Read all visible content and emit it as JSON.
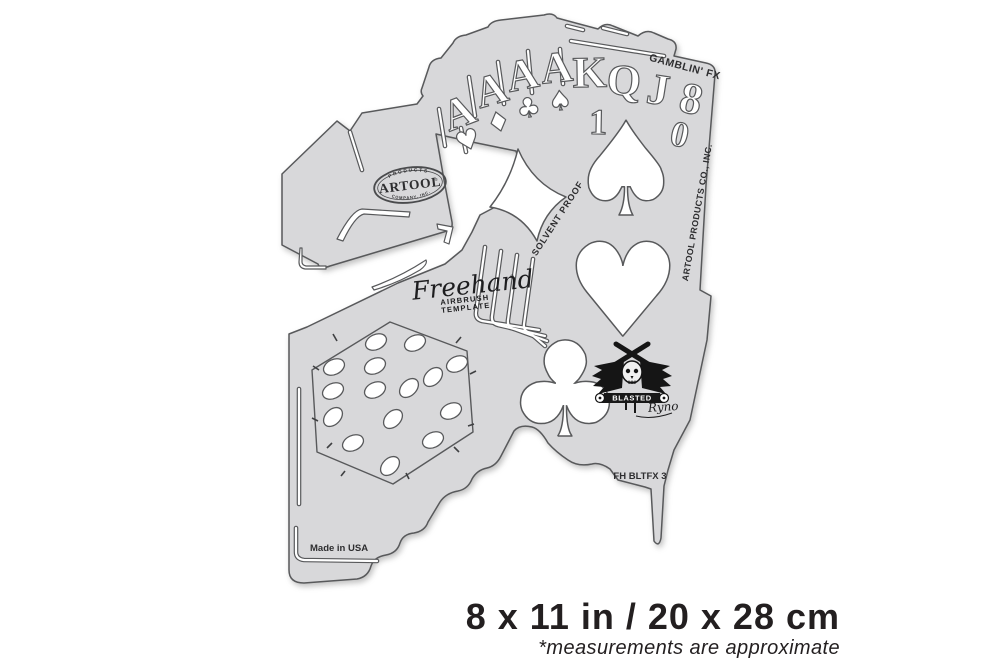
{
  "colors": {
    "background": "#ffffff",
    "template_fill": "#d8d8da",
    "outline": "#58595b",
    "print_dark": "#2d2d2f",
    "caption_text": "#231f20"
  },
  "template": {
    "series_label": "GAMBLIN' FX",
    "sku_label": "FH BLTFX 3",
    "made_in_label": "Made in USA",
    "solvent_proof_label": "SOLVENT PROOF",
    "side_label": "ARTOOL PRODUCTS CO., INC.",
    "brand_oval": {
      "top": "PRODUCTS",
      "name": "ARTOOL",
      "reg": "®",
      "bottom": "COMPANY, INC."
    },
    "freehand_logo": {
      "script": "Freehand",
      "reg": "®",
      "line1": "AIRBRUSH",
      "line2": "TEMPLATE"
    },
    "cards": {
      "ranks": [
        "A",
        "A",
        "A",
        "A",
        "K",
        "Q",
        "J",
        "8"
      ],
      "ten": [
        "1",
        "0"
      ],
      "suit_glyphs": {
        "heart": "♥",
        "diamond": "♦",
        "club": "♣",
        "spade": "♠"
      }
    },
    "artist_logo": {
      "word": "BLASTED",
      "signature": "Ryno"
    }
  },
  "caption": {
    "dimensions": "8 x 11 in / 20 x 28 cm",
    "note": "*measurements are approximate"
  }
}
